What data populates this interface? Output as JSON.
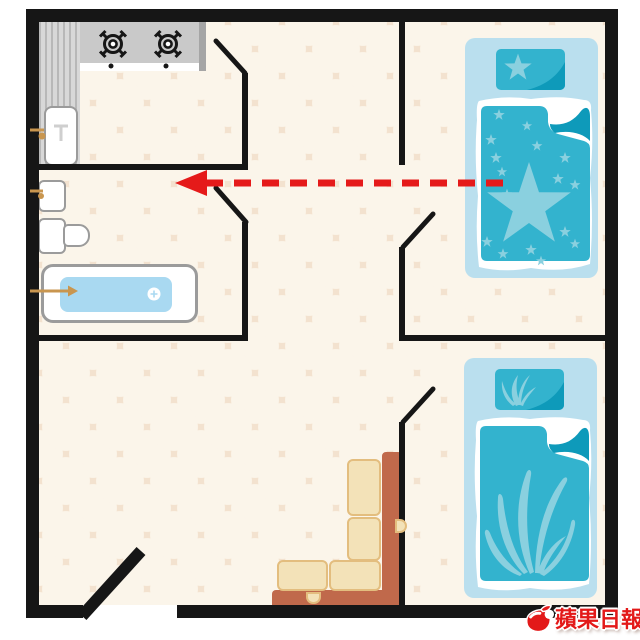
{
  "watermark": {
    "text": "蘋果日報",
    "icon": "apple-icon",
    "color": "#e31919"
  },
  "palette": {
    "wall": "#161616",
    "floor_base": "#f3e2cf",
    "floor_tile": "#fbf5ea",
    "counter": "#c9c9c9",
    "counter_stripe": "#b8b8b8",
    "counter_stripe_bg": "#d8d8d8",
    "counter_edge": "#a5a5a5",
    "fixture_border": "#9b9b9b",
    "water": "#a9d9f1",
    "faucet": "#c9964f",
    "bed_base": "#badfee",
    "bed_teal": "#33b3ce",
    "bed_teal_dark": "#0e9aba",
    "bed_pattern": "#8ad0df",
    "sofa_back": "#c0694b",
    "sofa_cushion": "#f3e2b8",
    "sofa_cushion_border": "#e3bd7e",
    "arrow_red": "#e51a1a",
    "brand_red": "#e31919"
  },
  "floorplan": {
    "type": "apartment-floor-plan",
    "rooms": [
      {
        "name": "kitchen",
        "position": "top-left",
        "fixtures": [
          "two-burner-stove",
          "striped-side-counter",
          "kitchen-sink"
        ]
      },
      {
        "name": "bathroom",
        "position": "mid-left",
        "fixtures": [
          "wash-basin",
          "toilet",
          "bathtub-with-water"
        ]
      },
      {
        "name": "bedroom-top",
        "position": "top-right",
        "fixtures": [
          "single-bed-star-bedding"
        ]
      },
      {
        "name": "bedroom-bottom",
        "position": "bottom-right",
        "fixtures": [
          "single-bed-leaf-bedding"
        ]
      },
      {
        "name": "living-area",
        "position": "center-bottom",
        "fixtures": [
          "l-shaped-sofa",
          "entrance-door-open"
        ]
      }
    ],
    "doors": [
      "kitchen-door-swing",
      "bathroom-door-swing",
      "bedroom-top-door-swing",
      "bedroom-bottom-door-swing",
      "front-door-leaf"
    ],
    "arrow": {
      "style": "dashed",
      "color": "#e51a1a",
      "direction": "left",
      "from": "bed-in-top-bedroom",
      "to": "kitchen-bathroom-doorway"
    }
  }
}
